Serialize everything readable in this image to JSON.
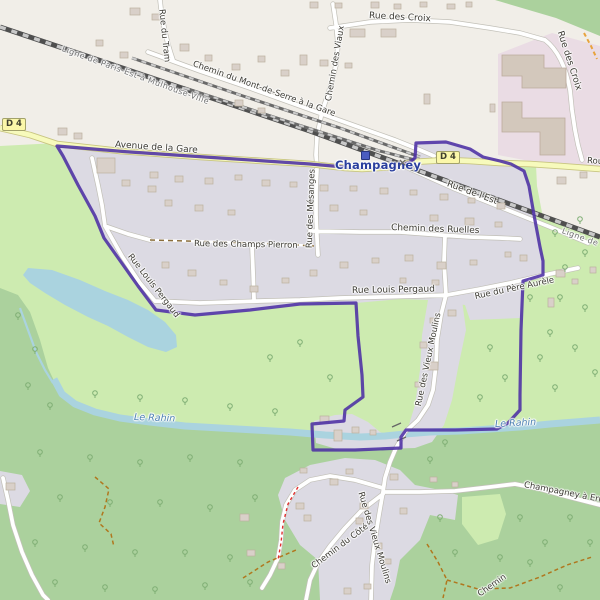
{
  "map_title": "Champagney commune map",
  "place": {
    "town": "Champagney"
  },
  "labels": {
    "ligne_railway": "Ligne de Paris-Est à Mulhouse-Ville",
    "rue_du_tram": "Rue du Tram",
    "chemin_du_mont": "Chemin du Mont-de-Serre à la Gare",
    "rue_des_croix": "Rue des Croix",
    "chemin_des_viaux": "Chemin des Viaux",
    "route_partial": "Route",
    "d4": "D 4",
    "avenue_de_la_gare": "Avenue de la Gare",
    "rue_de_l_est": "Rue de l'Est",
    "chemin_des_ruelles": "Chemin des Ruelles",
    "rue_des_mesanges": "Rue des Mésanges",
    "rue_des_champs_pierron": "Rue des Champs Pierron",
    "rue_louis_pergaud": "Rue Louis Pergaud",
    "rue_du_pere_aurele": "Rue du Père Aurèle",
    "rue_des_vieux_moulins": "Rue des Vieux Moulins",
    "chemin_du_cote": "Chemin du Côté",
    "champagney_a_errevet": "Champagney à Errevet",
    "chemin_partial": "Chemin",
    "le_rahin": "Le Rahin"
  },
  "icons": {
    "railway_station": "railway-station-square",
    "level_crossing_glyph": "×"
  },
  "colors": {
    "boundary": "#4c2fa4",
    "water": "#aad3df",
    "forest": "#abd19d",
    "grass": "#cdebb0",
    "residential": "#dcdae3",
    "industrial": "#eadce4",
    "road_secondary": "#f7fabc",
    "land": "#f1eee8",
    "building": "#d9d0c9"
  }
}
